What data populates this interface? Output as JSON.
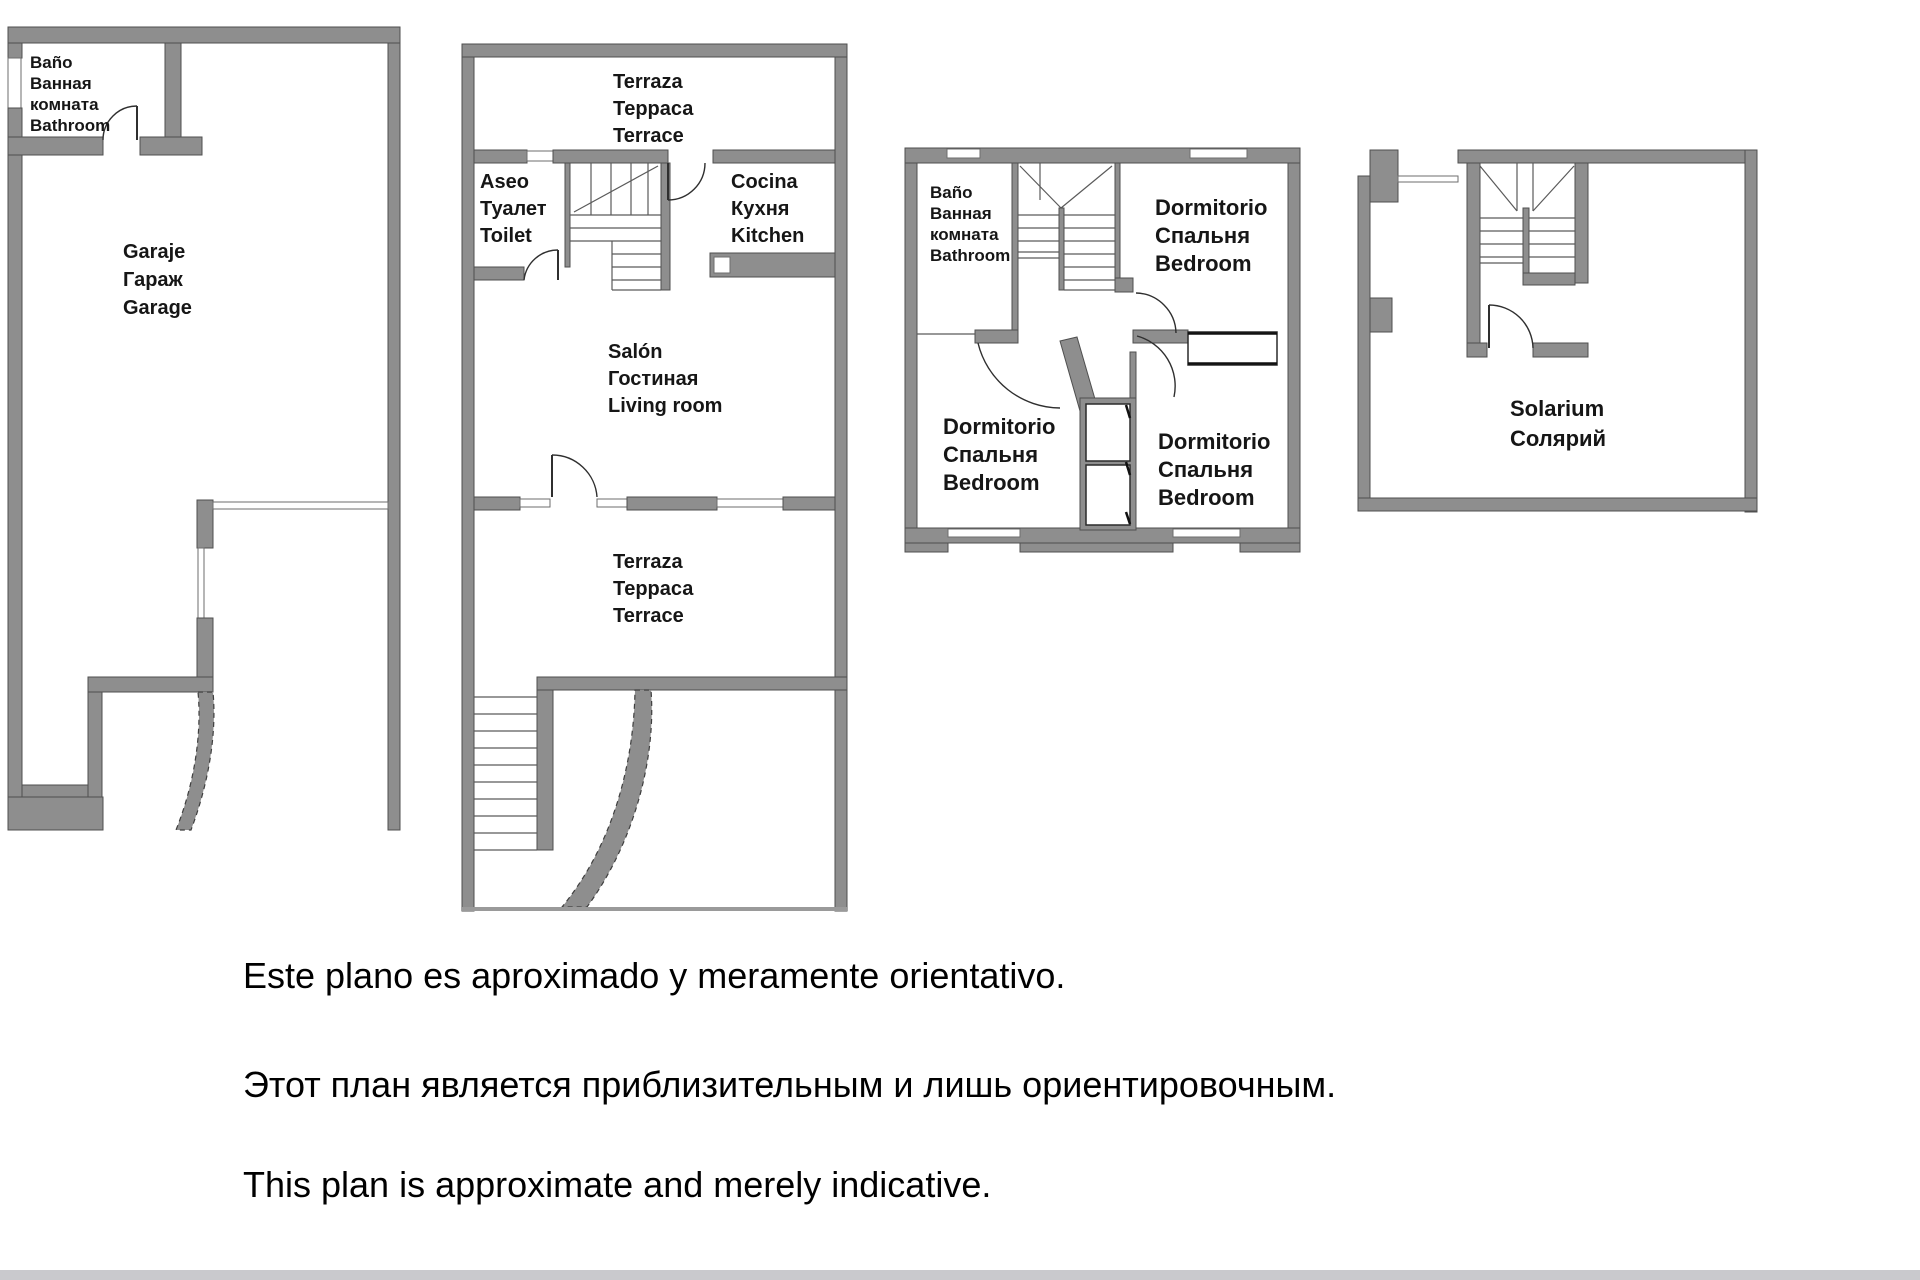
{
  "colors": {
    "wall_gray": "#8e8e8e",
    "wall_edge": "#4f4f4f",
    "label_text": "#161616",
    "disclaimer_text": "#000000",
    "bottom_bar": "#c9c9cd",
    "background": "#ffffff"
  },
  "plans": {
    "garage_floor": {
      "bathroom": [
        "Baño",
        "Ванная",
        "комната",
        "Bathroom"
      ],
      "garage": [
        "Garaje",
        "Гараж",
        "Garage"
      ]
    },
    "main_floor": {
      "terrace_top": [
        "Terraza",
        "Терраса",
        "Terrace"
      ],
      "toilet": [
        "Aseo",
        "Туалет",
        "Toilet"
      ],
      "kitchen": [
        "Cocina",
        "Кухня",
        "Kitchen"
      ],
      "living_room": [
        "Salón",
        "Гостиная",
        "Living room"
      ],
      "terrace_bottom": [
        "Terraza",
        "Терраса",
        "Terrace"
      ]
    },
    "bedroom_floor": {
      "bathroom": [
        "Baño",
        "Ванная",
        "комната",
        "Bathroom"
      ],
      "bedroom_top_right": [
        "Dormitorio",
        "Спальня",
        "Bedroom"
      ],
      "bedroom_bottom_left": [
        "Dormitorio",
        "Спальня",
        "Bedroom"
      ],
      "bedroom_bottom_right": [
        "Dormitorio",
        "Спальня",
        "Bedroom"
      ]
    },
    "solarium_floor": {
      "solarium": [
        "Solarium",
        "Солярий"
      ]
    }
  },
  "disclaimer": {
    "es": "Este plano es aproximado y meramente orientativo.",
    "ru": "Этот план является приблизительным и лишь ориентировочным.",
    "en": "This plan is approximate and merely indicative."
  }
}
